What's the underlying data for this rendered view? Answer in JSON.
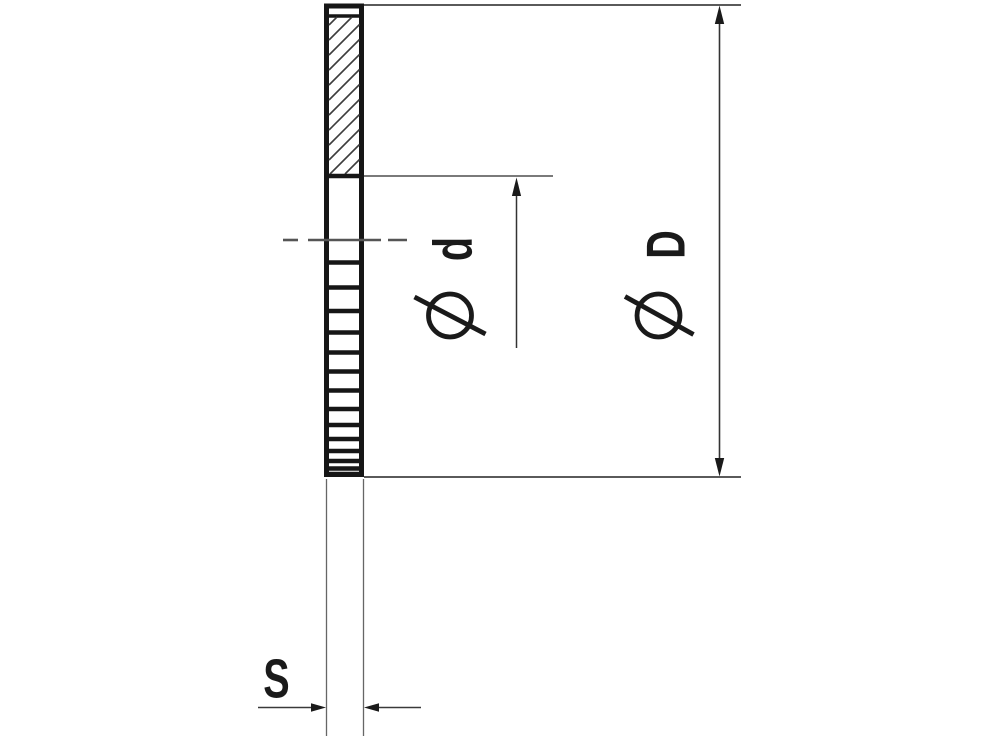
{
  "drawing": {
    "description": "Dimensional side view of a serrated lock washer, upper half shown in section",
    "labels": {
      "inner_diameter_letter": "d",
      "outer_diameter_letter": "D",
      "thickness_letter": "S"
    },
    "symbols": {
      "diameter_symbol": "⌀"
    },
    "colors": {
      "outline": "#161616",
      "thin_line": "#4f4f4f",
      "hatch": "#3d3d3d",
      "centerline": "#555555",
      "background": "#ffffff"
    },
    "geometry": {
      "centerline_y": 240,
      "centerline_dashes": [
        [
          283,
          298
        ],
        [
          308,
          381
        ],
        [
          388,
          407
        ]
      ],
      "serration_line_ys": [
        262.5,
        287.5,
        311,
        332.5,
        352.5,
        371.5,
        390.5,
        409,
        425,
        439,
        451,
        461,
        468.5,
        474
      ],
      "hatch_region": {
        "x1": 329,
        "y1": 17,
        "x2": 359.5,
        "y2": 174,
        "vertical_step": 15
      }
    }
  }
}
